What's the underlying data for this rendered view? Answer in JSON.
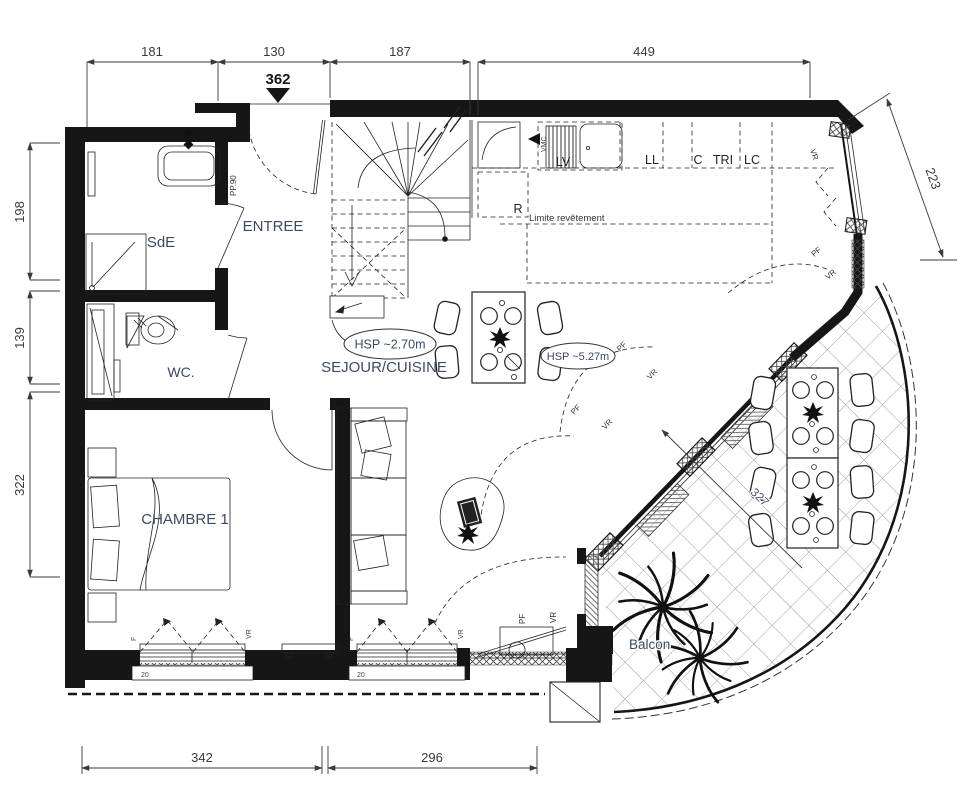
{
  "title": "Plan d'appartement - niveau",
  "colors": {
    "wall": "#161616",
    "line": "#222222",
    "room_label": "#3c4a63",
    "dim": "#3a3a3a",
    "hatch": "#9a9a9a"
  },
  "rooms": {
    "sde": "SdE",
    "entree": "ENTREE",
    "wc": "WC.",
    "chambre": "CHAMBRE 1",
    "sejour": "SEJOUR/CUISINE",
    "balcon": "Balcon"
  },
  "ceiling": {
    "hsp_low": "HSP ~2.70m",
    "hsp_high": "HSP ~5.27m"
  },
  "kitchen": {
    "vmc": "VMC",
    "lv": "LV",
    "fridge": "R",
    "ll": "LL",
    "c": "C",
    "tri": "TRI",
    "lc": "LC",
    "limit": "Limite revêtement"
  },
  "openings": {
    "entry_door": "PP.90",
    "window": "F",
    "shutter": "VR",
    "french_door": "PF",
    "sill": "20"
  },
  "dims": {
    "top": [
      "181",
      "130",
      "187",
      "449"
    ],
    "entry_level": "362",
    "right": "223",
    "left": [
      "198",
      "139",
      "322"
    ],
    "bottom": [
      "342",
      "296"
    ],
    "balcony": "327"
  }
}
